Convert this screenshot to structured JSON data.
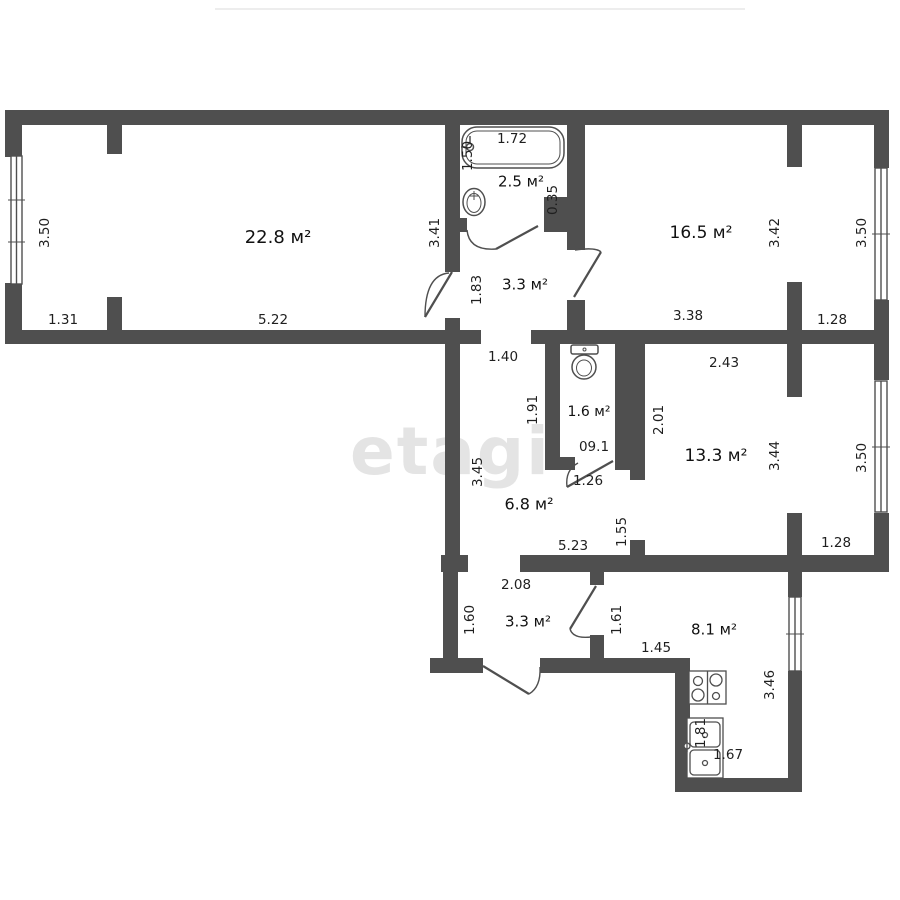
{
  "watermark": "etagi",
  "plan": {
    "wall_color": "#4f4f4f",
    "label_color": "#1f1f1f",
    "watermark_color": "#e4e4e4",
    "area_unit": "м²"
  },
  "rooms": [
    {
      "name": "room-22-8",
      "label": "22.8 м²",
      "x": 278,
      "y": 238,
      "size": 18
    },
    {
      "name": "bathroom",
      "label": "2.5 м²",
      "x": 521,
      "y": 182,
      "size": 15
    },
    {
      "name": "hall-upper",
      "label": "3.3 м²",
      "x": 525,
      "y": 285,
      "size": 15
    },
    {
      "name": "room-16-5",
      "label": "16.5 м²",
      "x": 701,
      "y": 233,
      "size": 17
    },
    {
      "name": "wc",
      "label": "1.6 м²",
      "x": 589,
      "y": 412,
      "size": 14
    },
    {
      "name": "room-13-3",
      "label": "13.3 м²",
      "x": 716,
      "y": 456,
      "size": 17
    },
    {
      "name": "hall-lower",
      "label": "6.8 м²",
      "x": 529,
      "y": 505,
      "size": 16
    },
    {
      "name": "entry-room",
      "label": "3.3 м²",
      "x": 528,
      "y": 622,
      "size": 15
    },
    {
      "name": "kitchen",
      "label": "8.1 м²",
      "x": 714,
      "y": 630,
      "size": 15
    }
  ],
  "dimensions": [
    {
      "text": "3.50",
      "x": 45,
      "y": 233,
      "v": 1
    },
    {
      "text": "1.31",
      "x": 63,
      "y": 320,
      "v": 0
    },
    {
      "text": "5.22",
      "x": 273,
      "y": 320,
      "v": 0
    },
    {
      "text": "3.41",
      "x": 435,
      "y": 233,
      "v": 1
    },
    {
      "text": "1.72",
      "x": 512,
      "y": 139,
      "v": 0
    },
    {
      "text": "1.50",
      "x": 468,
      "y": 156,
      "v": 1
    },
    {
      "text": "0.35",
      "x": 553,
      "y": 200,
      "v": 1
    },
    {
      "text": "1.83",
      "x": 477,
      "y": 290,
      "v": 1
    },
    {
      "text": "3.42",
      "x": 775,
      "y": 233,
      "v": 1
    },
    {
      "text": "3.38",
      "x": 688,
      "y": 316,
      "v": 0
    },
    {
      "text": "3.50",
      "x": 862,
      "y": 233,
      "v": 1
    },
    {
      "text": "1.28",
      "x": 832,
      "y": 320,
      "v": 0
    },
    {
      "text": "1.40",
      "x": 503,
      "y": 357,
      "v": 0
    },
    {
      "text": "1.91",
      "x": 533,
      "y": 410,
      "v": 1
    },
    {
      "text": "09.1",
      "x": 594,
      "y": 447,
      "v": 0
    },
    {
      "text": "2.01",
      "x": 659,
      "y": 420,
      "v": 1
    },
    {
      "text": "2.43",
      "x": 724,
      "y": 363,
      "v": 0
    },
    {
      "text": "3.44",
      "x": 775,
      "y": 456,
      "v": 1
    },
    {
      "text": "3.50",
      "x": 862,
      "y": 458,
      "v": 1
    },
    {
      "text": "1.28",
      "x": 836,
      "y": 543,
      "v": 0
    },
    {
      "text": "1.26",
      "x": 588,
      "y": 481,
      "v": 0
    },
    {
      "text": "3.45",
      "x": 478,
      "y": 472,
      "v": 1
    },
    {
      "text": "5.23",
      "x": 573,
      "y": 546,
      "v": 0
    },
    {
      "text": "1.55",
      "x": 622,
      "y": 532,
      "v": 1
    },
    {
      "text": "2.08",
      "x": 516,
      "y": 585,
      "v": 0
    },
    {
      "text": "1.60",
      "x": 470,
      "y": 620,
      "v": 1
    },
    {
      "text": "1.61",
      "x": 617,
      "y": 620,
      "v": 1
    },
    {
      "text": "1.45",
      "x": 656,
      "y": 648,
      "v": 0
    },
    {
      "text": "3.46",
      "x": 770,
      "y": 685,
      "v": 1
    },
    {
      "text": "1.81",
      "x": 701,
      "y": 733,
      "v": 1
    },
    {
      "text": "1.67",
      "x": 728,
      "y": 755,
      "v": 0
    }
  ],
  "fixtures": [
    {
      "icon": "bathtub-icon"
    },
    {
      "icon": "wash-basin-icon"
    },
    {
      "icon": "toilet-icon"
    },
    {
      "icon": "stove-icon"
    },
    {
      "icon": "kitchen-sink-icon"
    }
  ]
}
